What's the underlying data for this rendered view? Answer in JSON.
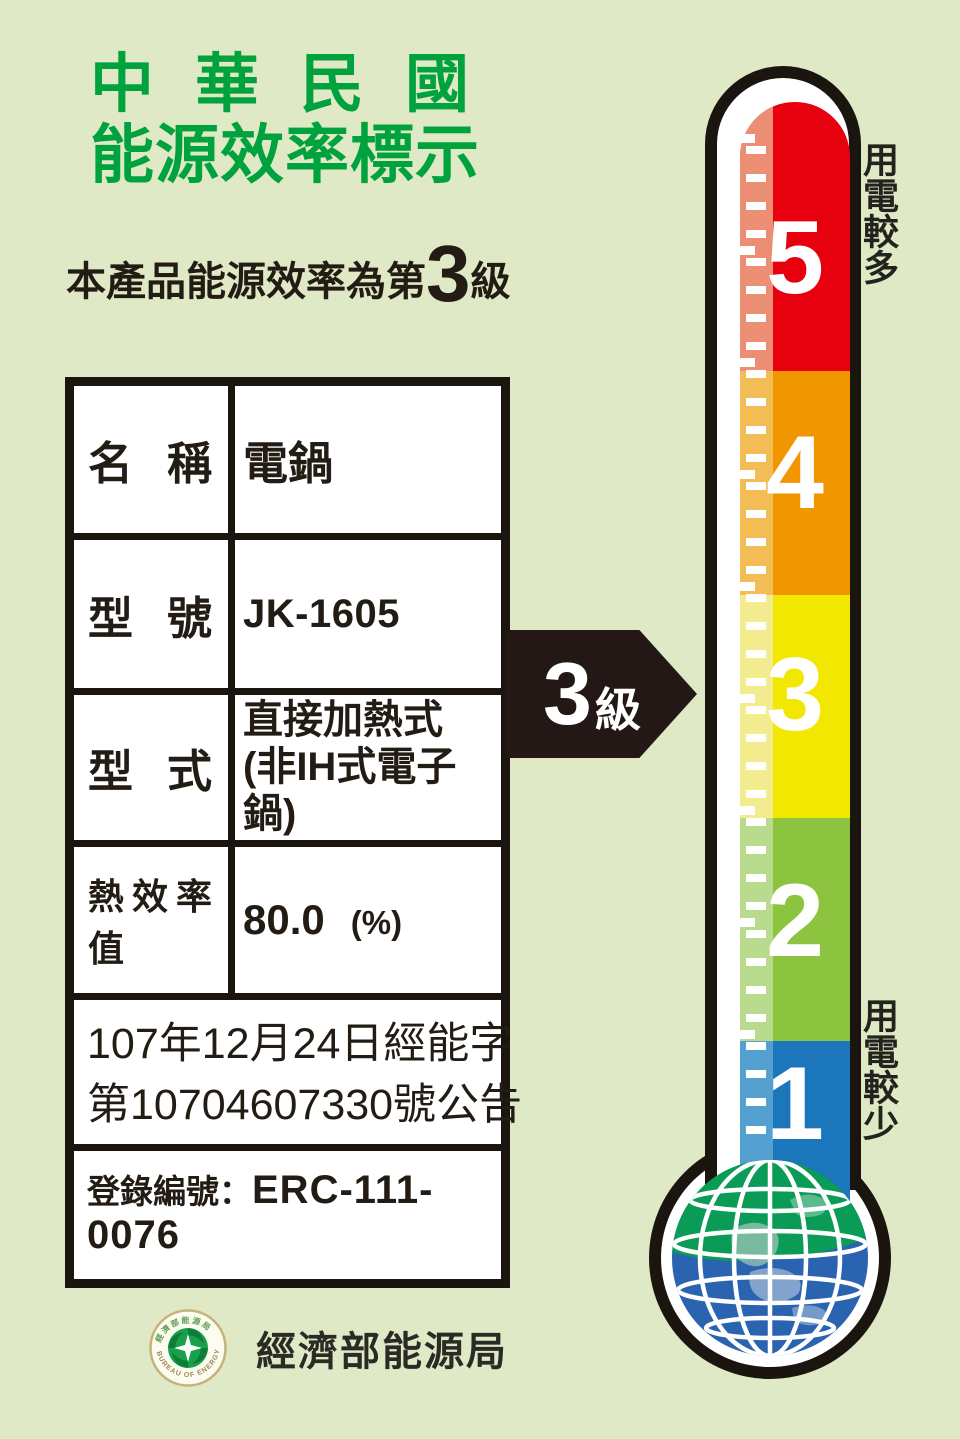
{
  "header": {
    "title_line1": "中華民國",
    "title_line2": "能源效率標示"
  },
  "subtitle": {
    "prefix": "本產品能源效率為第",
    "grade": "3",
    "suffix": "級"
  },
  "table": {
    "rows": [
      {
        "label": "名稱",
        "value": "電鍋"
      },
      {
        "label": "型號",
        "value": "JK-1605"
      },
      {
        "label": "型式",
        "value_line1": "直接加熱式",
        "value_line2": "(非IH式電子鍋)"
      },
      {
        "label": "熱效率值",
        "value": "80.0",
        "unit": "(%)"
      }
    ],
    "announcement_line1": "107年12月24日經能字",
    "announcement_line2": "第10704607330號公告",
    "registration_label": "登錄編號：",
    "registration_value": "ERC-111-0076"
  },
  "arrow": {
    "grade": "3",
    "suffix": "級"
  },
  "thermometer": {
    "selected_grade": "3",
    "levels": [
      {
        "grade": "5",
        "color": "#e7000e",
        "tint": "#ec8e74"
      },
      {
        "grade": "4",
        "color": "#f29600",
        "tint": "#f3bd55"
      },
      {
        "grade": "3",
        "color": "#f2e700",
        "tint": "#f2ec8f"
      },
      {
        "grade": "2",
        "color": "#8cc43f",
        "tint": "#b9db8d"
      },
      {
        "grade": "1",
        "color": "#1b76bb",
        "tint": "#54a0d1"
      }
    ],
    "label_top": "用電較多",
    "label_bottom": "用電較少"
  },
  "footer": {
    "agency": "經濟部能源局",
    "seal_text_top": "經濟部能源局",
    "seal_text_bottom": "BUREAU OF ENERGY"
  },
  "colors": {
    "background": "#dfe9c5",
    "title_green": "#00a23e",
    "text_black": "#231c15",
    "outline_black": "#1b1510",
    "globe_green": "#0a9b57",
    "globe_blue": "#2a63b0"
  }
}
